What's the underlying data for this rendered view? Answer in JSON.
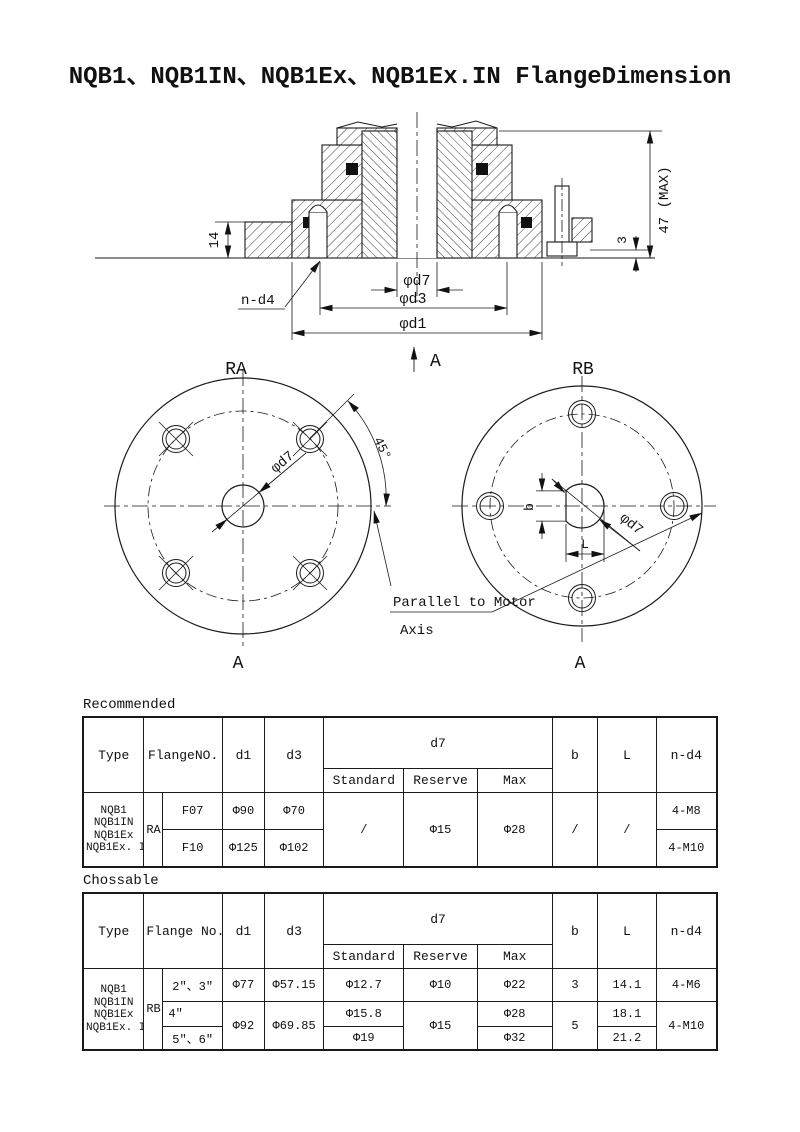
{
  "title": "NQB1、NQB1IN、NQB1Ex、NQB1Ex.IN FlangeDimension",
  "drawing": {
    "dim_47": "47 (MAX)",
    "dim_14": "14",
    "dim_3": "3",
    "label_nd4": "n-d4",
    "dim_d7": "φd7",
    "dim_d3": "φd3",
    "dim_d1": "φd1",
    "label_A": "A",
    "view_ra": {
      "title": "RA",
      "angle": "45°",
      "dim_d7": "φd7",
      "label_A": "A"
    },
    "view_rb": {
      "title": "RB",
      "dim_b": "b",
      "dim_L": "L",
      "dim_d7": "φd7",
      "label_A": "A"
    },
    "note_line1": "Parallel to Motor",
    "note_line2": "Axis"
  },
  "recommended": {
    "heading": "Recommended",
    "header": {
      "type": "Type",
      "flange_no": "FlangeNO.",
      "d1": "d1",
      "d3": "d3",
      "d7": "d7",
      "standard": "Standard",
      "reserve": "Reserve",
      "max": "Max",
      "b": "b",
      "l": "L",
      "n_d4": "n-d4"
    },
    "type_lines": [
      "NQB1",
      "NQB1IN",
      "NQB1Ex",
      "NQB1Ex. IN"
    ],
    "group": "RA",
    "rows": [
      {
        "flange": "F07",
        "d1": "Φ90",
        "d3": "Φ70",
        "n_d4": "4-M8"
      },
      {
        "flange": "F10",
        "d1": "Φ125",
        "d3": "Φ102",
        "n_d4": "4-M10"
      }
    ],
    "merged": {
      "standard": "/",
      "reserve": "Φ15",
      "max": "Φ28",
      "b": "/",
      "l": "/"
    }
  },
  "chossable": {
    "heading": "Chossable",
    "header": {
      "type": "Type",
      "flange_no": "Flange No.",
      "d1": "d1",
      "d3": "d3",
      "d7": "d7",
      "standard": "Standard",
      "reserve": "Reserve",
      "max": "Max",
      "b": "b",
      "l": "L",
      "n_d4": "n-d4"
    },
    "type_lines": [
      "NQB1",
      "NQB1IN",
      "NQB1Ex",
      "NQB1Ex. IN"
    ],
    "group": "RB",
    "row1": {
      "flange": "2\"、3\"",
      "d1": "Φ77",
      "d3": "Φ57.15",
      "standard": "Φ12.7",
      "reserve": "Φ10",
      "max": "Φ22",
      "b": "3",
      "l": "14.1",
      "n_d4": "4-M6"
    },
    "row2": {
      "flange": "4\"",
      "standard": "Φ15.8",
      "max": "Φ28",
      "l": "18.1"
    },
    "row3": {
      "flange": "5\"、6\"",
      "standard": "Φ19",
      "max": "Φ32",
      "l": "21.2"
    },
    "merged": {
      "d1": "Φ92",
      "d3": "Φ69.85",
      "reserve": "Φ15",
      "b": "5",
      "n_d4": "4-M10"
    }
  }
}
